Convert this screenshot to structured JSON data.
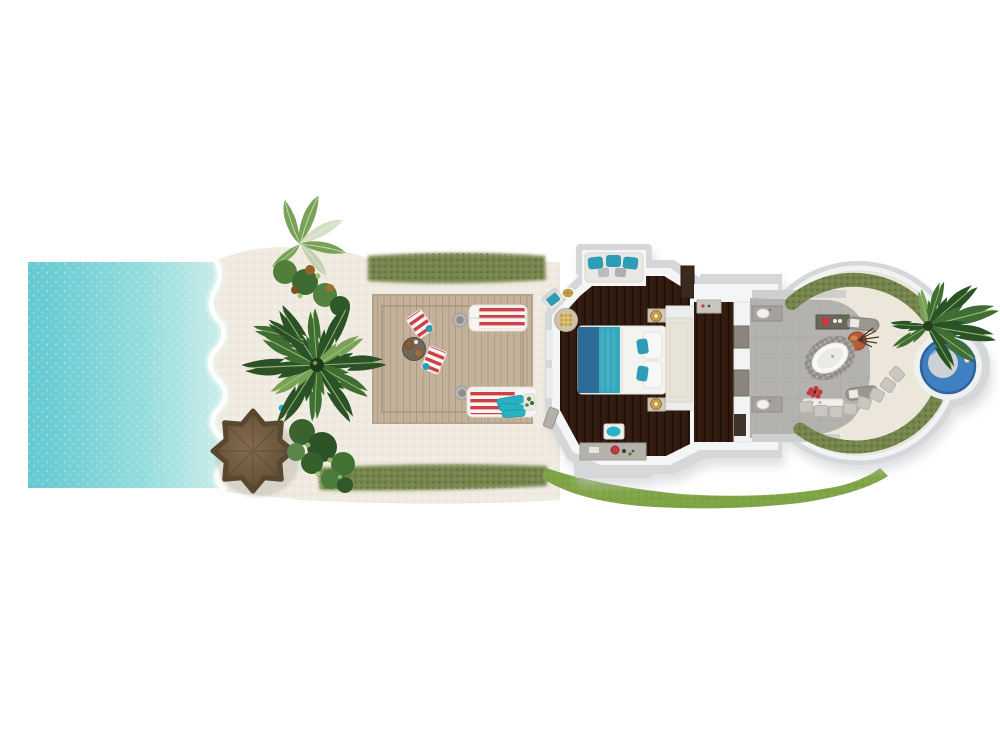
{
  "canvas": {
    "width": 1000,
    "height": 750,
    "background": "#ffffff"
  },
  "palette": {
    "page_bg": "#ffffff",
    "ocean_deep": "#64c8d2",
    "ocean_mid": "#93dcdc",
    "ocean_shore": "#d2efeb",
    "sand": "#f0ebe0",
    "courtyard_sand": "#ece7db",
    "deck_wood": "#c5b29b",
    "hedge_green": "#74854d",
    "hedge_dark": "#566b33",
    "grass_green": "#7fa445",
    "palm_dark": "#2a5226",
    "palm_mid": "#3f6e33",
    "palm_light": "#79a258",
    "umbrella_brown": "#846c4e",
    "umbrella_dark": "#5c4931",
    "wall_gray": "#d5d7d9",
    "wall_white": "#f4f5f6",
    "wood_floor": "#301a0f",
    "bed_white": "#f3f3f0",
    "throw_blue": "#2b6d96",
    "runner_teal": "#38a8bd",
    "cushion_teal": "#2d9cb6",
    "headboard_cream": "#e9e4d9",
    "rug_tan": "#cfc1a7",
    "gold": "#c59f4a",
    "stone_gray": "#b4b2ae",
    "tub_white": "#f8f8f5",
    "pebble_gray": "#98968f",
    "vanity_dark": "#6d665d",
    "copper": "#b55b38",
    "red_accent": "#c8393f",
    "lounger_red": "#cf3f48",
    "lounger_white": "#f6f5f2",
    "towel_teal": "#27b2c3",
    "pool_blue": "#3f7fc2",
    "pool_blue_dark": "#2e639e",
    "stepping_stone": "#c9c7bf",
    "shadow_gray": "#c3c8cc"
  },
  "scene": {
    "view": "top-down",
    "elements": [
      {
        "name": "ocean",
        "color_ref": "ocean_deep"
      },
      {
        "name": "beach-sand",
        "color_ref": "sand"
      },
      {
        "name": "shoreline-foam",
        "color_ref": "page_bg"
      },
      {
        "name": "thatch-umbrella",
        "color_ref": "umbrella_brown"
      },
      {
        "name": "palm-tree-large",
        "color_ref": "palm_dark"
      },
      {
        "name": "tropical-foliage",
        "color_ref": "palm_mid"
      },
      {
        "name": "hedge-top",
        "color_ref": "hedge_green"
      },
      {
        "name": "hedge-bottom",
        "color_ref": "hedge_green"
      },
      {
        "name": "lawn-swath",
        "color_ref": "grass_green"
      },
      {
        "name": "timber-deck",
        "color_ref": "deck_wood"
      },
      {
        "name": "sun-lounger-top",
        "color_ref": "lounger_red"
      },
      {
        "name": "sun-lounger-bottom",
        "color_ref": "lounger_red"
      },
      {
        "name": "deck-chairs-and-table",
        "color_ref": "lounger_red"
      },
      {
        "name": "villa-walls",
        "color_ref": "wall_gray"
      },
      {
        "name": "bedroom-floor",
        "color_ref": "wood_floor"
      },
      {
        "name": "alcove-sofa",
        "color_ref": "cushion_teal"
      },
      {
        "name": "double-bed",
        "color_ref": "bed_white"
      },
      {
        "name": "round-rug",
        "color_ref": "rug_tan"
      },
      {
        "name": "dressing-corridor",
        "color_ref": "wood_floor"
      },
      {
        "name": "bathroom-stone-floor",
        "color_ref": "stone_gray"
      },
      {
        "name": "bathtub-oval",
        "color_ref": "tub_white"
      },
      {
        "name": "twin-vanities",
        "color_ref": "vanity_dark"
      },
      {
        "name": "copper-vessel",
        "color_ref": "copper"
      },
      {
        "name": "stepping-stones",
        "color_ref": "stepping_stone"
      },
      {
        "name": "courtyard-hedge",
        "color_ref": "hedge_green"
      },
      {
        "name": "plunge-pool",
        "color_ref": "pool_blue"
      },
      {
        "name": "pool-palm",
        "color_ref": "palm_mid"
      }
    ]
  }
}
